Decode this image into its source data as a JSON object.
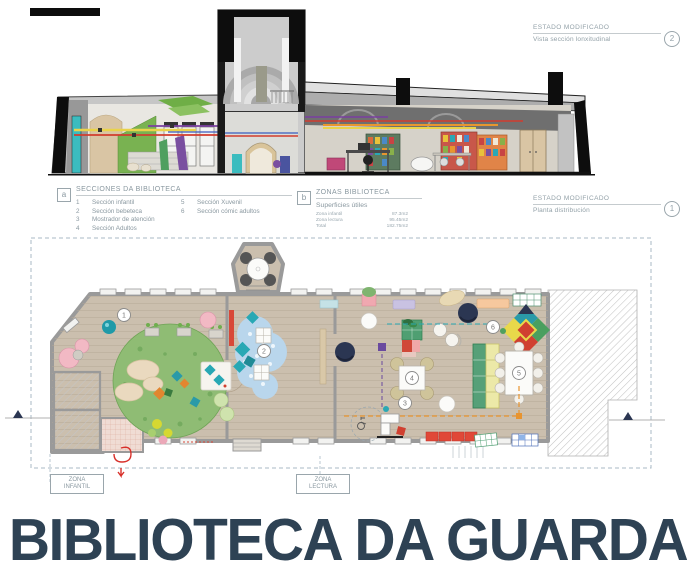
{
  "title": "BIBLIOTECA DA GUARDA",
  "annotations": {
    "section": {
      "heading": "ESTADO MODIFICADO",
      "subtitle": "Vista sección lonxitudinal",
      "ref": "2"
    },
    "plan": {
      "heading": "ESTADO MODIFICADO",
      "subtitle": "Planta distribución",
      "ref": "1"
    }
  },
  "legend_secciones": {
    "key": "a",
    "title": "SECCIONES DA BIBLIOTECA",
    "col1": [
      {
        "num": "1",
        "label": "Sección infantil"
      },
      {
        "num": "2",
        "label": "Sección bebeteca"
      },
      {
        "num": "3",
        "label": "Mostrador de atención"
      },
      {
        "num": "4",
        "label": "Sección Adultos"
      }
    ],
    "col2": [
      {
        "num": "5",
        "label": "Sección Xuvenil"
      },
      {
        "num": "6",
        "label": "Sección cómic adultos"
      }
    ]
  },
  "legend_zonas": {
    "key": "b",
    "title": "ZONAS BIBLIOTECA",
    "subtitle": "Superficies útiles",
    "rows": [
      {
        "label": "Zona infantil",
        "value": "87.3m2"
      },
      {
        "label": "Zona lectura",
        "value": "95.45m2"
      },
      {
        "label": "Total",
        "value": "182.75m2"
      }
    ]
  },
  "plan_markers": {
    "m1": "1",
    "m2": "2",
    "m3": "3",
    "m4": "4",
    "m5": "5",
    "m6": "6"
  },
  "zone_labels": {
    "infantil": {
      "line1": "ZONA",
      "line2": "INFANTIL"
    },
    "lectura": {
      "line1": "ZONA",
      "line2": "LECTURA"
    }
  },
  "colors": {
    "title": "#2e4254",
    "annotation_text": "#93a1a8",
    "floor_wood": "#cbbfae",
    "rug_green": "#8fbc74",
    "rug_blue": "#b9d6ec",
    "accent_teal": "#2aa8b4",
    "accent_red": "#d8432f",
    "accent_orange": "#e8942f",
    "accent_navy": "#2b3652"
  }
}
